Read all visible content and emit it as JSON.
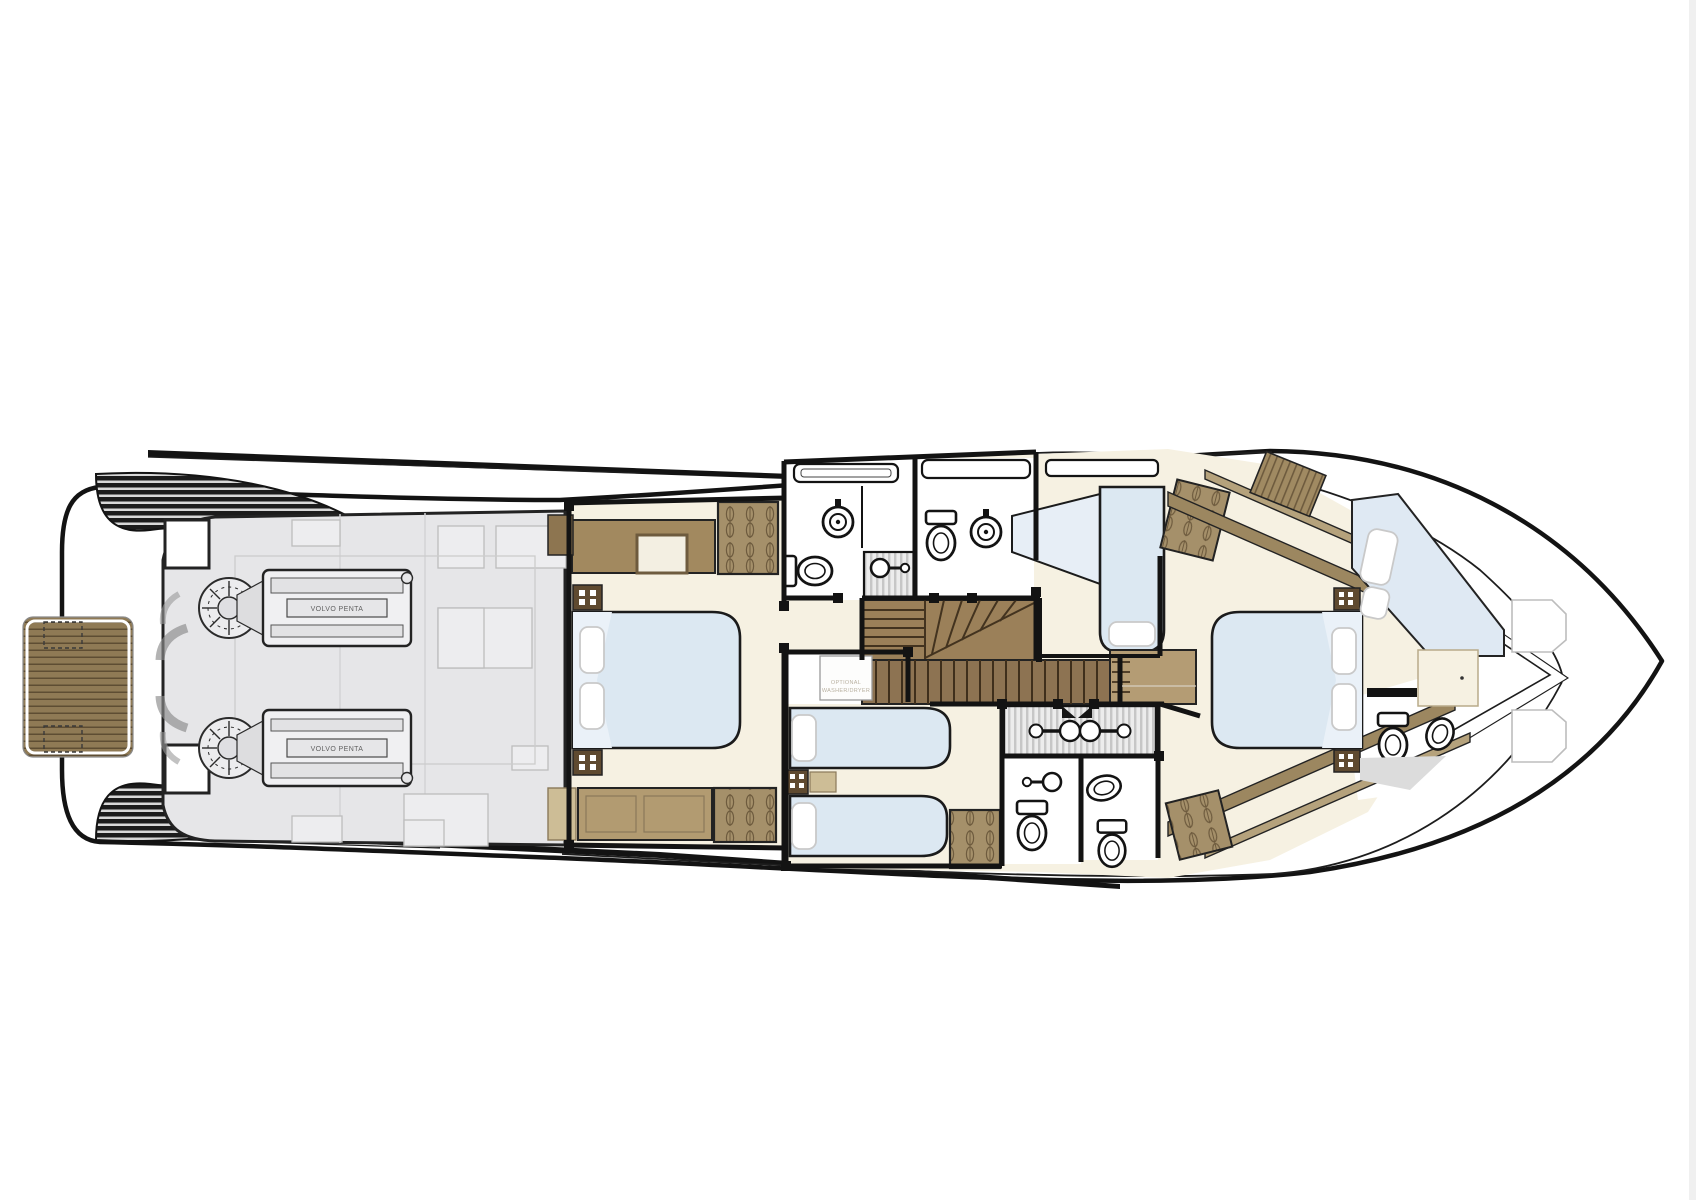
{
  "image": {
    "type": "yacht-lower-deck-floor-plan",
    "width": 1696,
    "height": 1200,
    "background": "#ffffff"
  },
  "palette": {
    "hull_line": "#131313",
    "floor_cream": "#f6f1e2",
    "engine_room_gray": "#e6e6e8",
    "teak": "#8f7a55",
    "wood_stair": "#9b8059",
    "wood_dark_line": "#43331f",
    "cabinet_beige": "#b29b71",
    "wardrobe_brown": "#a5906a",
    "bed_blue": "#dce8f2",
    "bed_fold": "#eaf1f8",
    "pillow_white": "#ffffff",
    "shower_stripe": "#c6c6c6",
    "stern_hatch_dark": "#1c1c1c"
  },
  "annotations": {
    "engine_label": "VOLVO PENTA",
    "washer_note_line1": "OPTIONAL",
    "washer_note_line2": "WASHER/DRYER"
  }
}
